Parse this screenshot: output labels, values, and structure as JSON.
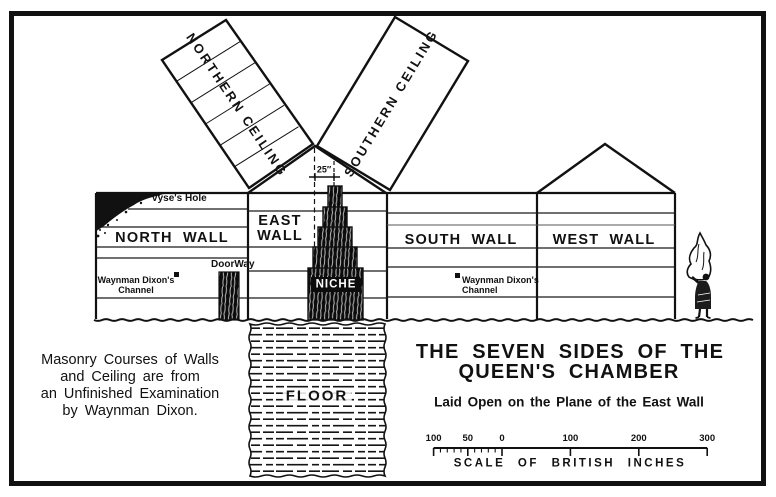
{
  "diagram": {
    "ceilings": {
      "northern": "NORTHERN CEILING",
      "southern": "SOUTHERN CEILING"
    },
    "walls": {
      "north": "NORTH WALL",
      "east1": "EAST",
      "east2": "WALL",
      "south": "SOUTH WALL",
      "west": "WEST WALL"
    },
    "features": {
      "vyses_hole": "Vyse's Hole",
      "doorway": "DoorWay",
      "niche": "NICHE",
      "floor": "FLOOR",
      "niche_offset": "25″",
      "north_channel1": "Waynman Dixon's",
      "north_channel2": "Channel",
      "south_channel1": "Waynman Dixon's",
      "south_channel2": "Channel"
    }
  },
  "note": {
    "lines": [
      "Masonry Courses of Walls",
      "and Ceiling are from",
      "an Unfinished Examination",
      "by Waynman Dixon."
    ]
  },
  "title": {
    "line1": "THE SEVEN SIDES OF THE",
    "line2": "QUEEN'S CHAMBER",
    "subtitle": "Laid Open on the Plane of the East Wall"
  },
  "scale_bar": {
    "caption": "SCALE OF BRITISH INCHES",
    "left_values": [
      100,
      50,
      0
    ],
    "right_values": [
      100,
      200,
      300
    ],
    "minor_tick_interval": 10
  },
  "colors": {
    "ink": "#111111",
    "paper": "#ffffff"
  }
}
